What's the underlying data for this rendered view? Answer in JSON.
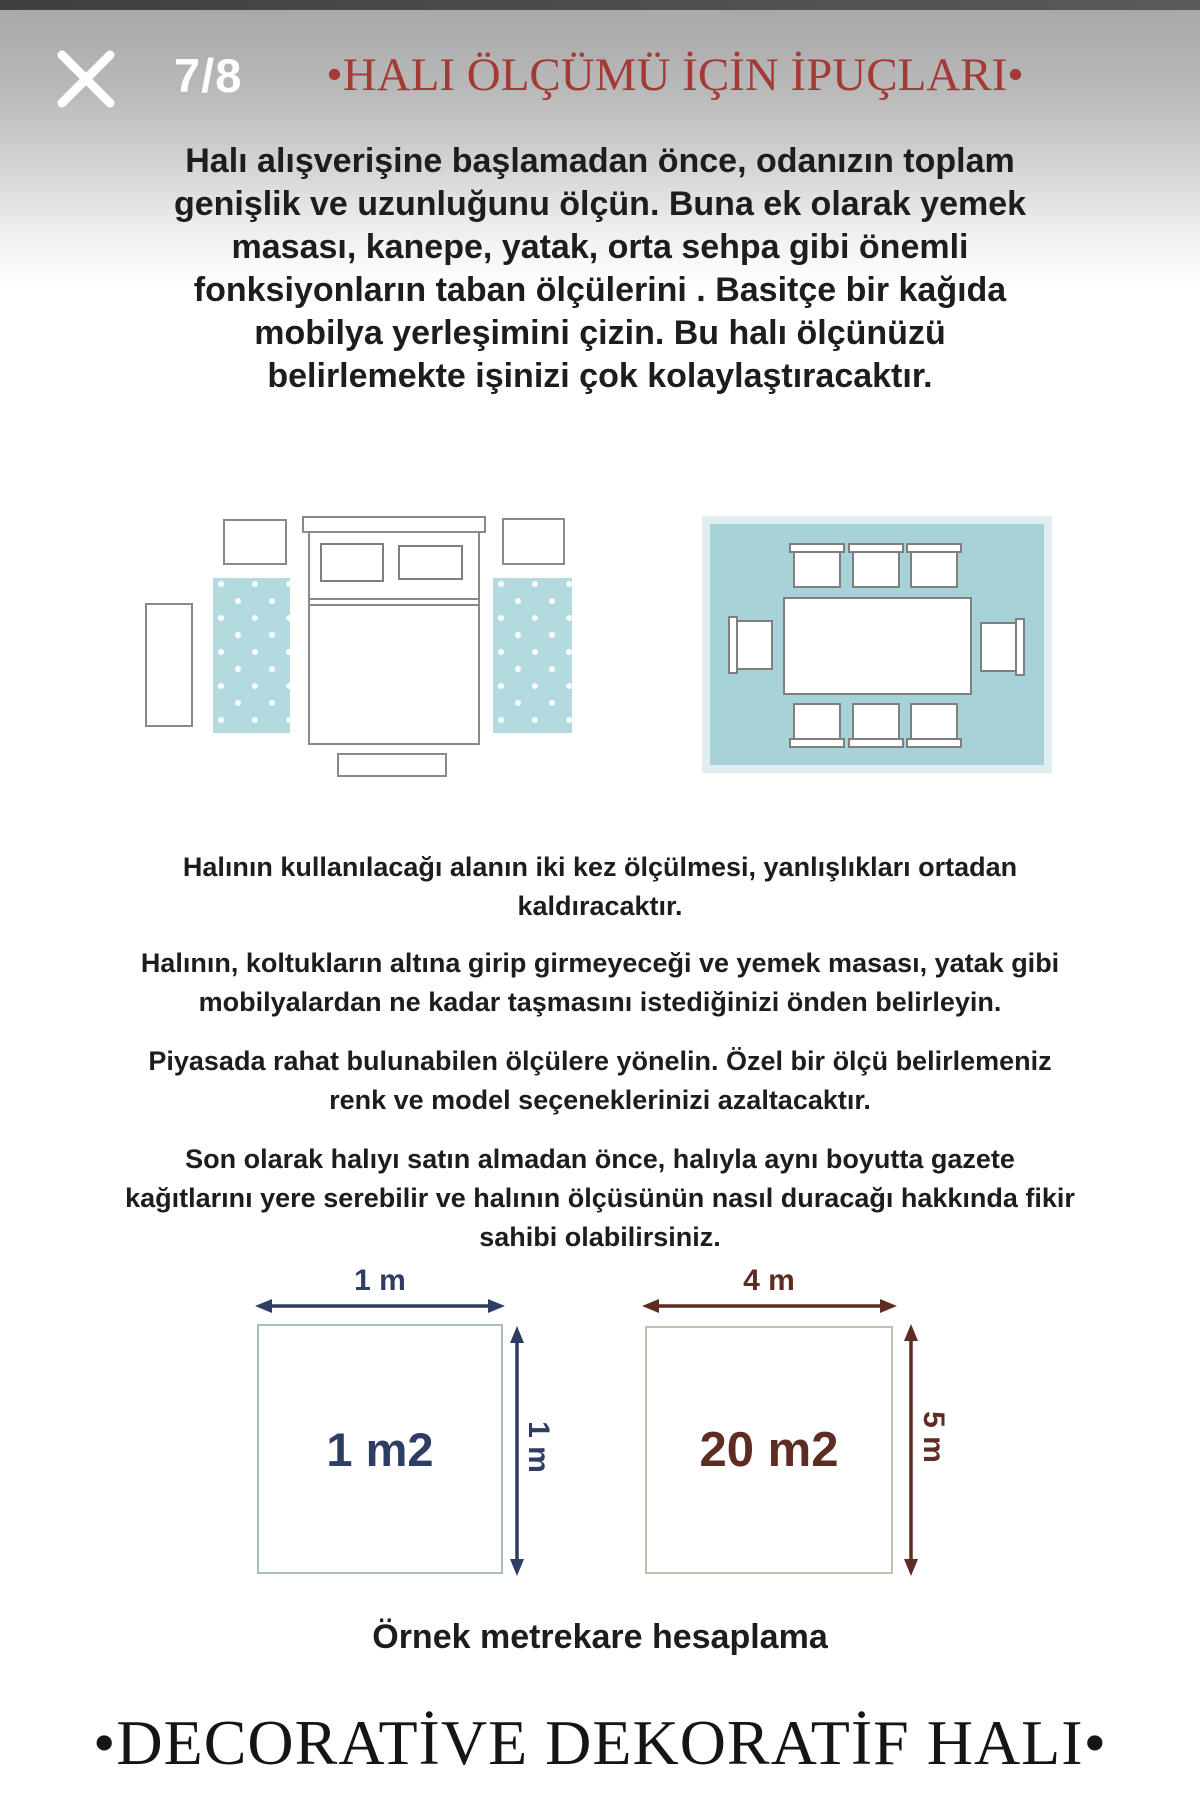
{
  "viewer": {
    "page_indicator": "7/8",
    "close_icon": "close-x"
  },
  "header": {
    "title": "•HALI ÖLÇÜMÜ İÇİN İPUÇLARI•",
    "title_color": "#a43a35"
  },
  "intro": {
    "lines": [
      "Halı alışverişine başlamadan önce, odanızın toplam",
      "genişlik ve uzunluğunu ölçün. Buna ek olarak yemek",
      "masası, kanepe, yatak, orta sehpa gibi önemli",
      "fonksiyonların taban ölçülerini . Basitçe bir kağıda",
      "mobilya yerleşimini çizin. Bu halı ölçünüzü",
      "belirlemekte işinizi çok kolaylaştıracaktır."
    ]
  },
  "tips": [
    {
      "lines": [
        "Halının kullanılacağı alanın iki kez ölçülmesi, yanlışlıkları ortadan",
        "kaldıracaktır."
      ]
    },
    {
      "lines": [
        "Halının, koltukların altına girip girmeyeceği ve yemek masası, yatak gibi",
        "mobilyalardan ne kadar taşmasını istediğinizi önden belirleyin."
      ]
    },
    {
      "lines": [
        "Piyasada rahat bulunabilen ölçülere yönelin. Özel bir ölçü belirlemeniz",
        "renk ve model seçeneklerinizi azaltacaktır."
      ]
    },
    {
      "lines": [
        "Son olarak halıyı satın almadan önce, halıyla aynı boyutta gazete",
        "kağıtlarını yere serebilir ve halının ölçüsünün nasıl duracağı hakkında fikir",
        "sahibi olabilirsiniz."
      ]
    }
  ],
  "diagrams": {
    "bedroom": "bed with two dotted runner rugs",
    "dining": "dining table with eight chairs on one rug",
    "rug_teal": "#a7d3d8",
    "runner_teal": "#b3dade",
    "outline_gray": "#8a8a8a"
  },
  "examples": {
    "small": {
      "width_label": "1 m",
      "height_label": "1 m",
      "area_label": "1 m2",
      "color": "#2e3d64"
    },
    "large": {
      "width_label": "4 m",
      "height_label": "5 m",
      "area_label": "20 m2",
      "color": "#5f2c23"
    }
  },
  "caption": "Örnek metrekare hesaplama",
  "footer": "•DECORATİVE DEKORATİF HALI•"
}
